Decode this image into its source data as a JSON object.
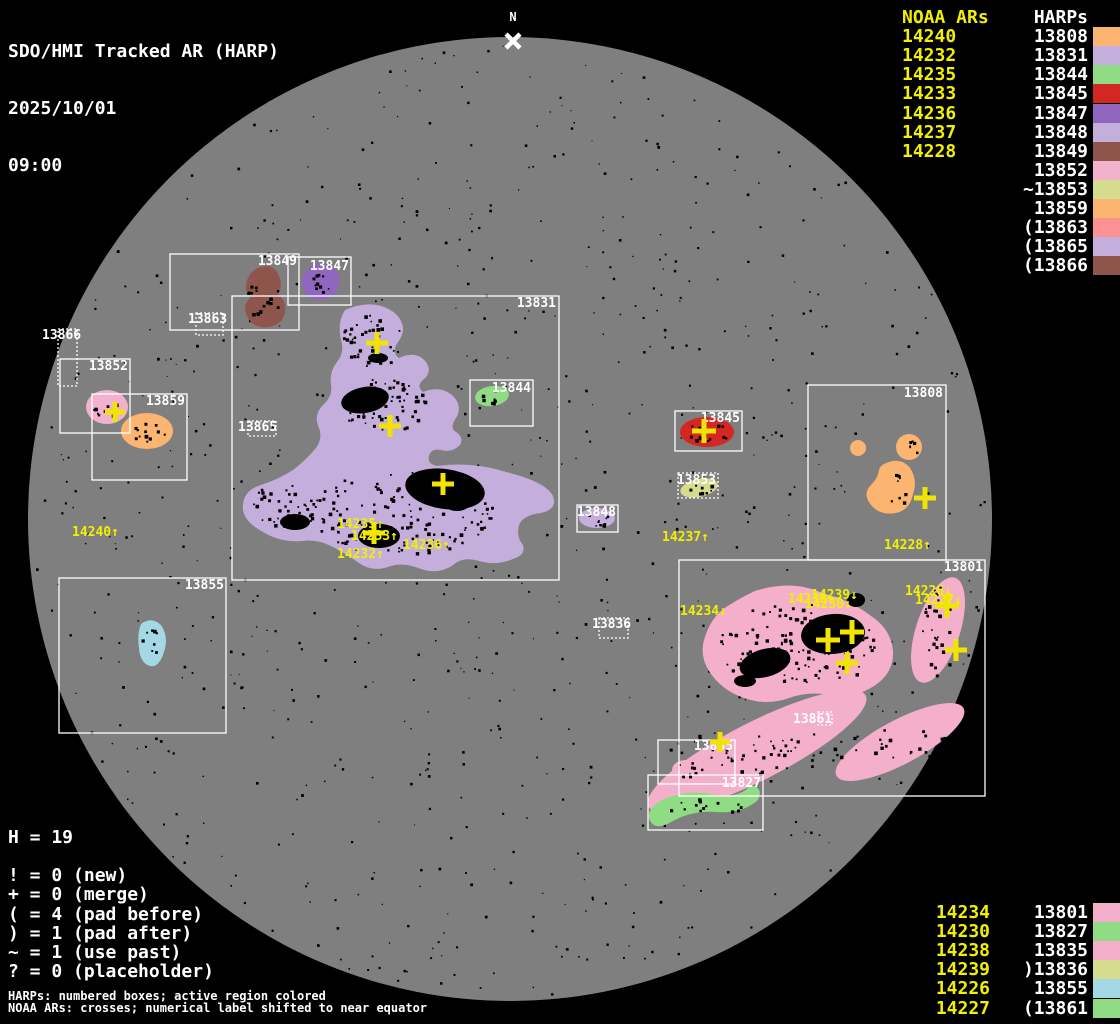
{
  "header": {
    "title": "SDO/HMI Tracked AR (HARP)",
    "date": "2025/10/01",
    "time": "09:00"
  },
  "north_marker": {
    "label": "N"
  },
  "colors": {
    "background": "#000000",
    "disk": "#7F7F7F",
    "noaa_yellow": "#F0F000",
    "cross_yellow": "#F0E400",
    "label_white": "#FFFFFF"
  },
  "legend_top_right": {
    "noaa_header": "NOAA ARs",
    "harp_header": "HARPs",
    "noaa_list": [
      "14240",
      "14232",
      "14235",
      "14233",
      "14236",
      "14237",
      "14228"
    ],
    "harps": [
      {
        "prefix": "",
        "num": "13808",
        "color": "#FBB571"
      },
      {
        "prefix": "",
        "num": "13831",
        "color": "#C4AFDC"
      },
      {
        "prefix": "",
        "num": "13844",
        "color": "#8FDC85"
      },
      {
        "prefix": "",
        "num": "13845",
        "color": "#D42724"
      },
      {
        "prefix": "",
        "num": "13847",
        "color": "#9066BE"
      },
      {
        "prefix": "",
        "num": "13848",
        "color": "#C4AFDC"
      },
      {
        "prefix": "",
        "num": "13849",
        "color": "#8D554B"
      },
      {
        "prefix": "",
        "num": "13852",
        "color": "#F2B2CE"
      },
      {
        "prefix": "~",
        "num": "13853",
        "color": "#D6DC8E"
      },
      {
        "prefix": "",
        "num": "13859",
        "color": "#FBB571"
      },
      {
        "prefix": "(",
        "num": "13863",
        "color": "#FC9193"
      },
      {
        "prefix": "(",
        "num": "13865",
        "color": "#C4AFDC"
      },
      {
        "prefix": "(",
        "num": "13866",
        "color": "#8D554B"
      }
    ]
  },
  "legend_bottom_right": {
    "rows": [
      {
        "noaa": "14234",
        "prefix": "",
        "harp": "13801",
        "color": "#F4AFCB"
      },
      {
        "noaa": "14230",
        "prefix": "",
        "harp": "13827",
        "color": "#8FDC85"
      },
      {
        "noaa": "14238",
        "prefix": "",
        "harp": "13835",
        "color": "#F4AFCB"
      },
      {
        "noaa": "14239",
        "prefix": ")",
        "harp": "13836",
        "color": "#D6DC8E"
      },
      {
        "noaa": "14226",
        "prefix": "",
        "harp": "13855",
        "color": "#A5D8E5"
      },
      {
        "noaa": "14227",
        "prefix": "(",
        "harp": "13861",
        "color": "#8FDC85"
      }
    ]
  },
  "stats": {
    "title": "H = 19",
    "lines": [
      "! = 0 (new)",
      "+ = 0 (merge)",
      "( = 4 (pad before)",
      ") = 1 (pad after)",
      "~ = 1 (use past)",
      "? = 0 (placeholder)"
    ]
  },
  "footnotes": [
    "HARPs: numbered boxes; active region colored",
    "NOAA ARs: crosses; numerical label shifted to near equator"
  ],
  "sun": {
    "regions": [
      "13852",
      "13859",
      "13849",
      "13847",
      "13831",
      "13844",
      "13845",
      "13853",
      "13848",
      "13808",
      "13855",
      "13801",
      "13835",
      "13827"
    ],
    "boxes": [
      {
        "harp": "13866",
        "x": 58,
        "y": 329,
        "w": 19,
        "h": 57,
        "dotted": true,
        "lx": 42,
        "ly": 330,
        "anchor": "start"
      },
      {
        "harp": "13852",
        "x": 60,
        "y": 359,
        "w": 70,
        "h": 74,
        "dotted": false,
        "lx": 128,
        "ly": 361,
        "anchor": "end"
      },
      {
        "harp": "13859",
        "x": 92,
        "y": 394,
        "w": 95,
        "h": 86,
        "dotted": false,
        "lx": 185,
        "ly": 396,
        "anchor": "end"
      },
      {
        "harp": "13849",
        "x": 170,
        "y": 254,
        "w": 129,
        "h": 76,
        "dotted": false,
        "lx": 297,
        "ly": 256,
        "anchor": "end"
      },
      {
        "harp": "13847",
        "x": 288,
        "y": 257,
        "w": 63,
        "h": 48,
        "dotted": false,
        "lx": 349,
        "ly": 261,
        "anchor": "end"
      },
      {
        "harp": "13863",
        "x": 196,
        "y": 313,
        "w": 27,
        "h": 22,
        "dotted": true,
        "lx": 188,
        "ly": 314,
        "anchor": "start"
      },
      {
        "harp": "13831",
        "x": 232,
        "y": 296,
        "w": 327,
        "h": 284,
        "dotted": false,
        "lx": 556,
        "ly": 298,
        "anchor": "end"
      },
      {
        "harp": "13844",
        "x": 470,
        "y": 380,
        "w": 63,
        "h": 46,
        "dotted": false,
        "lx": 531,
        "ly": 383,
        "anchor": "end"
      },
      {
        "harp": "13865",
        "x": 248,
        "y": 421,
        "w": 28,
        "h": 15,
        "dotted": true,
        "lx": 238,
        "ly": 422,
        "anchor": "start"
      },
      {
        "harp": "13845",
        "x": 675,
        "y": 411,
        "w": 67,
        "h": 40,
        "dotted": false,
        "lx": 740,
        "ly": 413,
        "anchor": "end"
      },
      {
        "harp": "13853",
        "x": 678,
        "y": 473,
        "w": 40,
        "h": 25,
        "dotted": true,
        "lx": 716,
        "ly": 475,
        "anchor": "end"
      },
      {
        "harp": "13848",
        "x": 577,
        "y": 505,
        "w": 41,
        "h": 27,
        "dotted": false,
        "lx": 616,
        "ly": 507,
        "anchor": "end"
      },
      {
        "harp": "13808",
        "x": 808,
        "y": 385,
        "w": 138,
        "h": 175,
        "dotted": false,
        "lx": 943,
        "ly": 388,
        "anchor": "end"
      },
      {
        "harp": "13855",
        "x": 59,
        "y": 578,
        "w": 167,
        "h": 155,
        "dotted": false,
        "lx": 224,
        "ly": 580,
        "anchor": "end"
      },
      {
        "harp": "13836",
        "x": 599,
        "y": 618,
        "w": 29,
        "h": 20,
        "dotted": true,
        "lx": 592,
        "ly": 619,
        "anchor": "start"
      },
      {
        "harp": "13801",
        "x": 679,
        "y": 560,
        "w": 306,
        "h": 236,
        "dotted": false,
        "lx": 983,
        "ly": 562,
        "anchor": "end"
      },
      {
        "harp": "13861",
        "x": 818,
        "y": 712,
        "w": 14,
        "h": 13,
        "dotted": true,
        "lx": 793,
        "ly": 714,
        "anchor": "start"
      },
      {
        "harp": "13835",
        "x": 658,
        "y": 740,
        "w": 77,
        "h": 44,
        "dotted": false,
        "lx": 733,
        "ly": 741,
        "anchor": "end"
      },
      {
        "harp": "13827",
        "x": 648,
        "y": 775,
        "w": 115,
        "h": 55,
        "dotted": false,
        "lx": 761,
        "ly": 778,
        "anchor": "end"
      }
    ],
    "noaa_labels": [
      {
        "text": "14240↑",
        "x": 72,
        "y": 527
      },
      {
        "text": "14235↑",
        "x": 337,
        "y": 519
      },
      {
        "text": "14233↑",
        "x": 351,
        "y": 531
      },
      {
        "text": "14232↑",
        "x": 337,
        "y": 549
      },
      {
        "text": "14236↑",
        "x": 403,
        "y": 540
      },
      {
        "text": "14237↑",
        "x": 662,
        "y": 532
      },
      {
        "text": "14228↑",
        "x": 884,
        "y": 540
      },
      {
        "text": "14234↓",
        "x": 680,
        "y": 606
      },
      {
        "text": "14238↓",
        "x": 788,
        "y": 594
      },
      {
        "text": "14230↓",
        "x": 805,
        "y": 599
      },
      {
        "text": "14239↓",
        "x": 811,
        "y": 590
      },
      {
        "text": "14226↓",
        "x": 905,
        "y": 586
      },
      {
        "text": "14227↓",
        "x": 915,
        "y": 595
      }
    ],
    "crosses": [
      {
        "x": 115,
        "y": 412,
        "s": 10
      },
      {
        "x": 377,
        "y": 343,
        "s": 11
      },
      {
        "x": 390,
        "y": 426,
        "s": 11
      },
      {
        "x": 443,
        "y": 484,
        "s": 11
      },
      {
        "x": 374,
        "y": 533,
        "s": 11
      },
      {
        "x": 704,
        "y": 431,
        "s": 12
      },
      {
        "x": 925,
        "y": 498,
        "s": 11
      },
      {
        "x": 852,
        "y": 632,
        "s": 12
      },
      {
        "x": 828,
        "y": 640,
        "s": 12
      },
      {
        "x": 847,
        "y": 663,
        "s": 11
      },
      {
        "x": 947,
        "y": 606,
        "s": 12
      },
      {
        "x": 956,
        "y": 650,
        "s": 11
      },
      {
        "x": 720,
        "y": 742,
        "s": 10
      }
    ]
  }
}
